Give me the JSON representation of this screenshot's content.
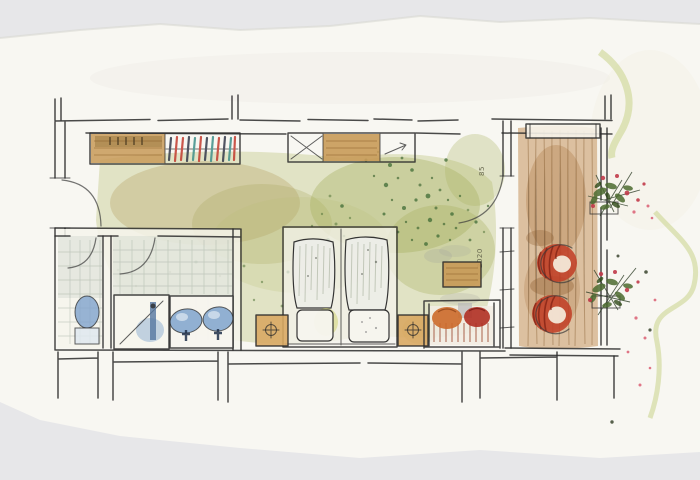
{
  "scene": {
    "type": "hand-drawn watercolor floor plan sketch",
    "room": "hotel room with bathroom, twin beds and balcony"
  },
  "palette": {
    "background": "#e7e7e9",
    "paper": "#f8f7f2",
    "ink": "#2b2b2b",
    "floor_wash_green": "#b9bf75",
    "floor_wash_dark_green": "#9aa84f",
    "hall_wash_olive": "#b59a5e",
    "speckle_green": "#3f6b35",
    "wood_tan": "#c89a58",
    "nightstand_tan": "#d9a963",
    "deck_brown": "#c08a4e",
    "fixture_blue": "#7fa3cc",
    "tile_gray": "#9aa79a",
    "chair_red": "#c14028",
    "cushion_orange": "#cc6a2a",
    "cushion_red": "#b03024",
    "plant_green": "#4c6b30",
    "flower_pink": "#c13a4a",
    "outside_wisp_green": "#c8d48a",
    "hanger_red": "#c23b2e",
    "hanger_teal": "#3f8f8a"
  },
  "annotations": {
    "dim_top": "85",
    "dim_bottom": "2020"
  },
  "legend": [
    "entrance-door",
    "wardrobe-shelf",
    "wardrobe-hangers",
    "sideboard-luggage-rack",
    "sideboard-drawers",
    "sideboard-minibar-arrow",
    "wc-toilet",
    "shower",
    "double-washbasin",
    "twin-beds",
    "nightstand-lamp",
    "side-table",
    "bench-with-cushions",
    "balcony-door",
    "balcony-deck",
    "red-armchair",
    "railing-planter-flowers",
    "dimension-annotation"
  ]
}
